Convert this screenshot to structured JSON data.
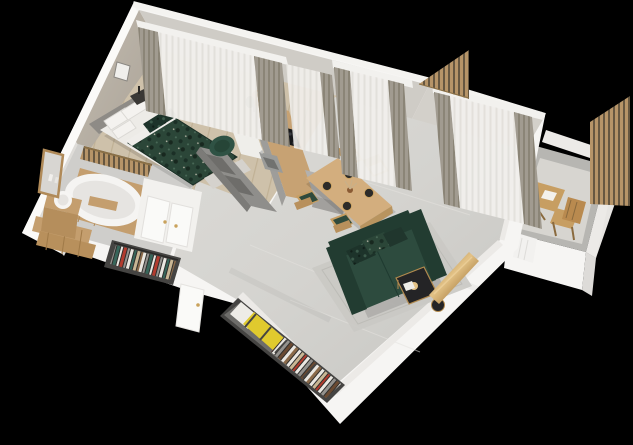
{
  "meta": {
    "title": "3D apartment floor plan render",
    "description": "Photorealistic isometric cutaway 3D render of a studio apartment floor plan on a black background, showing bedroom, bathroom, kitchen, dining area, living room, wardrobes and a balcony",
    "width": 633,
    "height": 445
  },
  "rooms": [
    {
      "id": "bedroom",
      "name": "Bedroom"
    },
    {
      "id": "bathroom",
      "name": "Bathroom"
    },
    {
      "id": "kitchen",
      "name": "Kitchen"
    },
    {
      "id": "dining-area",
      "name": "Dining area"
    },
    {
      "id": "living-room",
      "name": "Living room"
    },
    {
      "id": "hallway",
      "name": "Hallway / entry"
    },
    {
      "id": "wardrobe",
      "name": "Built-in wardrobes"
    },
    {
      "id": "balcony",
      "name": "Balcony"
    }
  ],
  "furniture": [
    {
      "room": "bedroom",
      "items": [
        "double-bed",
        "gray-headboard",
        "white-pillows",
        "green-patterned-duvet",
        "nightstand-with-lamp",
        "foot-bench",
        "vanity-desk",
        "green-desk-chair",
        "open-shelf-divider"
      ]
    },
    {
      "room": "bathroom",
      "items": [
        "freestanding-bathtub",
        "wood-vanity-with-basin",
        "framed-mirror",
        "wood-slat-partition",
        "wooden-steps",
        "wood-deck"
      ]
    },
    {
      "room": "kitchen",
      "items": [
        "kitchen-counter",
        "black-cooktop",
        "sink",
        "dried-flower-decor",
        "tall-cabinet"
      ]
    },
    {
      "room": "dining-area",
      "items": [
        "wooden-dining-table",
        "four-dining-chairs",
        "dark-plates",
        "dried-plant-centerpiece"
      ]
    },
    {
      "room": "living-room",
      "items": [
        "green-sofa",
        "patterned-throw-pillows",
        "area-rug",
        "coffee-table",
        "round-side-table",
        "gold-console"
      ]
    },
    {
      "room": "hallway",
      "items": [
        "double-doors",
        "entry-door",
        "hanging-clothes-wardrobe",
        "long-closet-with-boxes-and-clothes",
        "white-storage-box",
        "yellow-storage-boxes"
      ]
    },
    {
      "room": "balcony",
      "items": [
        "folding-wood-table",
        "folding-wood-chairs",
        "vertical-slat-screens",
        "radiator-panel"
      ]
    }
  ],
  "colors": {
    "bg": "#000000",
    "wallFace": "#f6f5f3",
    "wallBright": "#fbfaf8",
    "wallTop": "#eceae7",
    "wallInner": "#cfccc6",
    "plaster": "#b7b0a5",
    "bathWall": "#dedcd8",
    "woodFloor": "#cec1aa",
    "woodFloorLine": "#c0b195",
    "concrete": "#d6d5d1",
    "concreteDark": "#c8c7c3",
    "bathFloor": "#cfcecb",
    "woodDeck": "#c49e6e",
    "rug": "#cac9c4",
    "balconyFloor": "#b7b6b2",
    "balconyRug": "#d7d5d0",
    "slatWood": "#b69468",
    "slatGap": "#665741",
    "sheerA": "#f1efec",
    "sheerB": "#e3e1dc",
    "drapeA": "#a19b90",
    "drapeB": "#8b8577",
    "sofa": "#2d4b3e",
    "sofaDark": "#223c31",
    "cushionDark": "#1d332a",
    "duvet": "#2b4638",
    "duvetDark": "#1b2f26",
    "bedSheet": "#edebe7",
    "pillowWhite": "#f4f2ef",
    "headboard": "#8e8b86",
    "benchGray": "#d5d2cd",
    "chairGreen": "#2f5244",
    "counterWood": "#c7a273",
    "cabinetGray": "#9e9d9a",
    "cabinetDark": "#8e8d8a",
    "cooktop": "#17181a",
    "sinkSteel": "#9a9b99",
    "diningWood": "#d3ae7e",
    "chairWood": "#c79e62",
    "padWhite": "#e9e7e2",
    "padGreen": "#2f4a3c",
    "plate": "#2c2b29",
    "gold": "#b28a4e",
    "goldLight": "#e3c286",
    "goldDark": "#7a5c30",
    "tableDark": "#242426",
    "closetFrame": "#454442",
    "closetInner": "#6e6d6a",
    "yellowBox": "#e0ca2e",
    "whiteBox": "#eeece7",
    "doorWhite": "#fafaf8",
    "handleGold": "#c9a25c",
    "vanityWood": "#c49e6e",
    "tub": "#f5f4f2",
    "tubInner": "#e6e4e1",
    "mirror": "#d8d6d2",
    "lamp": "#3a3835",
    "clothWhite": "#eae7e1",
    "clothTeal": "#38665a",
    "clothRed": "#b23b2e",
    "clothGray": "#94928e",
    "clothBrown": "#8a6a4a",
    "clothTan": "#c9b694",
    "clothDark": "#2f2e2c",
    "flowerOrange": "#b5742f",
    "leafDark": "#2e3a34"
  }
}
